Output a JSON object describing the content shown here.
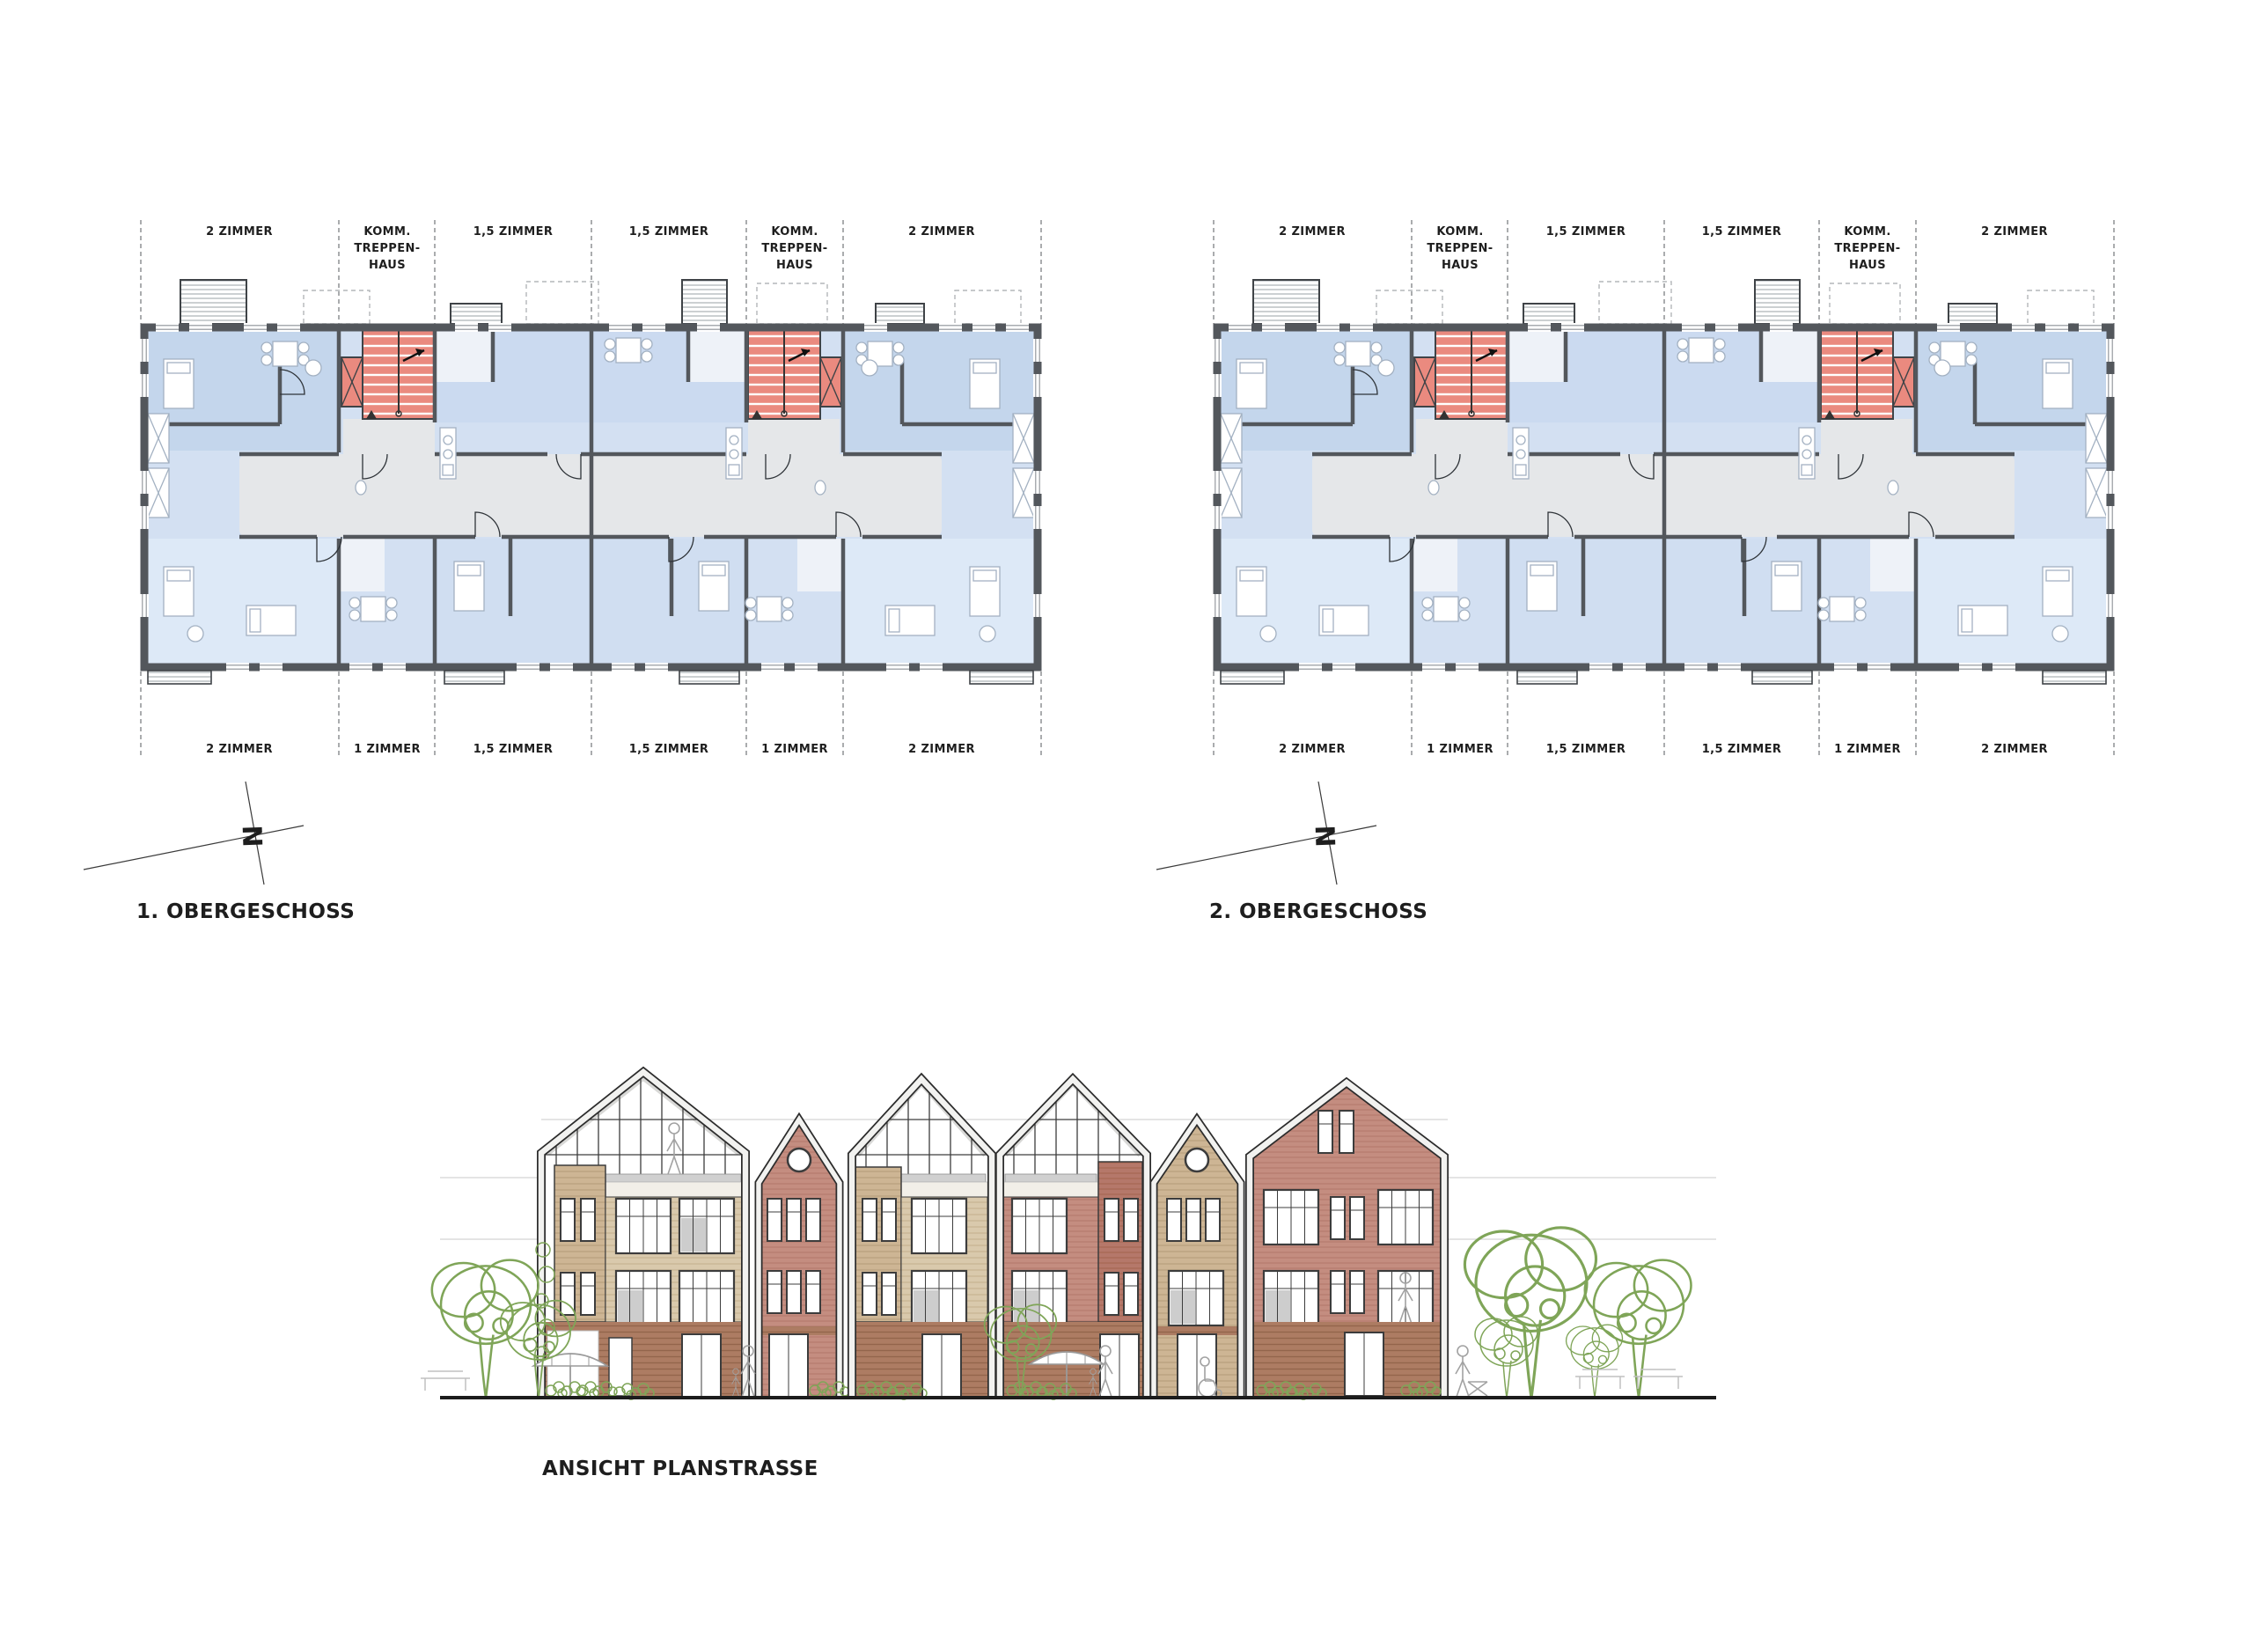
{
  "plans": [
    {
      "title": "1. OBERGESCHOSS",
      "north_letter": "N",
      "top_labels": [
        {
          "l1": "2 ZIMMER"
        },
        {
          "l1": "KOMM.",
          "l2": "TREPPEN-",
          "l3": "HAUS"
        },
        {
          "l1": "1,5 ZIMMER"
        },
        {
          "l1": "1,5 ZIMMER"
        },
        {
          "l1": "KOMM.",
          "l2": "TREPPEN-",
          "l3": "HAUS"
        },
        {
          "l1": "2 ZIMMER"
        }
      ],
      "bottom_labels": [
        {
          "l1": "2 ZIMMER"
        },
        {
          "l1": "1 ZIMMER"
        },
        {
          "l1": "1,5 ZIMMER"
        },
        {
          "l1": "1,5 ZIMMER"
        },
        {
          "l1": "1 ZIMMER"
        },
        {
          "l1": "2 ZIMMER"
        }
      ]
    },
    {
      "title": "2. OBERGESCHOSS",
      "north_letter": "N",
      "top_labels": [
        {
          "l1": "2 ZIMMER"
        },
        {
          "l1": "KOMM.",
          "l2": "TREPPEN-",
          "l3": "HAUS"
        },
        {
          "l1": "1,5 ZIMMER"
        },
        {
          "l1": "1,5 ZIMMER"
        },
        {
          "l1": "KOMM.",
          "l2": "TREPPEN-",
          "l3": "HAUS"
        },
        {
          "l1": "2 ZIMMER"
        }
      ],
      "bottom_labels": [
        {
          "l1": "2 ZIMMER"
        },
        {
          "l1": "1 ZIMMER"
        },
        {
          "l1": "1,5 ZIMMER"
        },
        {
          "l1": "1,5 ZIMMER"
        },
        {
          "l1": "1 ZIMMER"
        },
        {
          "l1": "2 ZIMMER"
        }
      ]
    }
  ],
  "elevation": {
    "title": "ANSICHT PLANSTRASSE"
  },
  "colors": {
    "wall_dark": "#53575c",
    "room_blue": "#d3e0f2",
    "room_blue_dark": "#c4d6ec",
    "room_blue_pale": "#dde9f7",
    "corridor_gray": "#e5e7e9",
    "stair_red": "#ea8a7f",
    "brick": "#c48d80",
    "brick_dark": "#b5786a",
    "wood": "#d9c9ac",
    "wood_dark": "#cdb594",
    "plinth_brick": "#ad7c63",
    "foliage_green": "#7fa558",
    "ink": "#1e1e1e"
  }
}
